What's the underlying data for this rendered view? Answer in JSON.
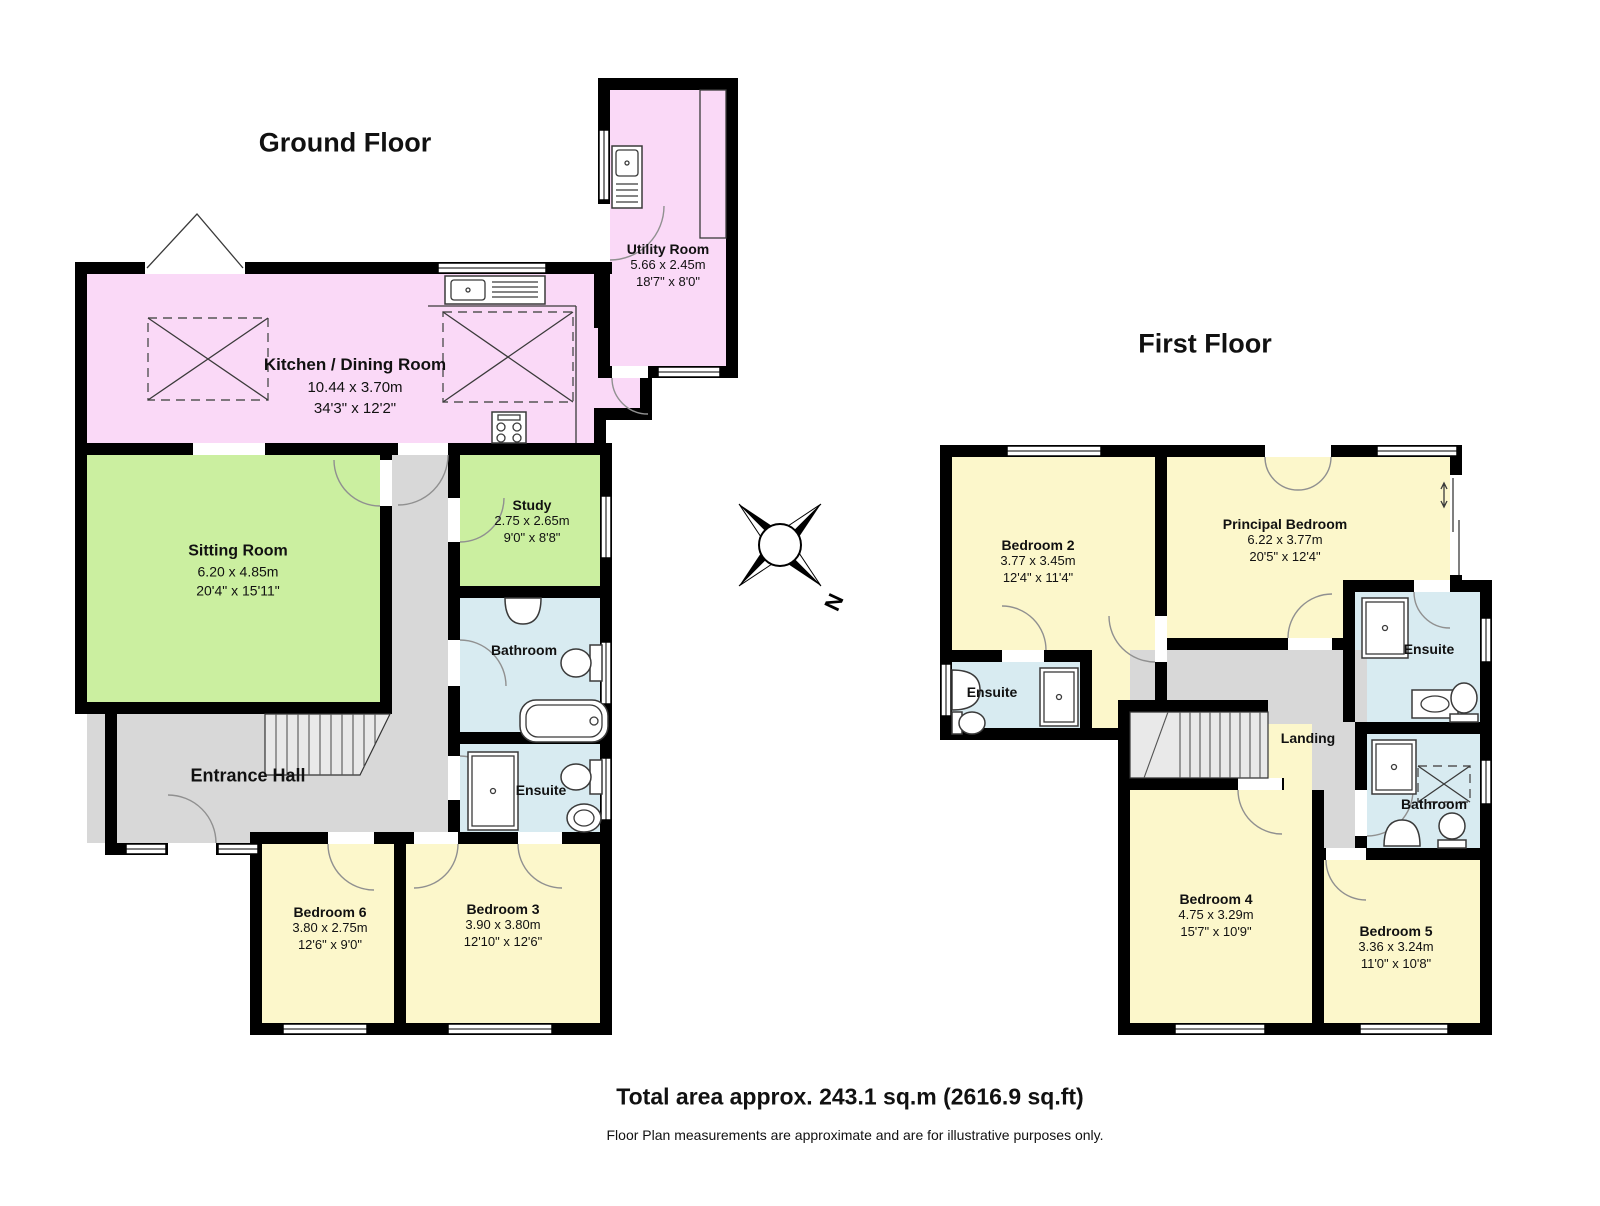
{
  "gf": {
    "title": "Ground Floor",
    "rooms": {
      "utility": {
        "name": "Utility Room",
        "dims_m": "5.66 x 2.45m",
        "dims_ft": "18'7\" x 8'0\""
      },
      "kitchen": {
        "name": "Kitchen / Dining Room",
        "dims_m": "10.44 x 3.70m",
        "dims_ft": "34'3\" x 12'2\""
      },
      "sitting": {
        "name": "Sitting Room",
        "dims_m": "6.20 x 4.85m",
        "dims_ft": "20'4\" x 15'11\""
      },
      "study": {
        "name": "Study",
        "dims_m": "2.75 x 2.65m",
        "dims_ft": "9'0\" x 8'8\""
      },
      "bathroom": {
        "name": "Bathroom"
      },
      "ensuite": {
        "name": "Ensuite"
      },
      "hall": {
        "name": "Entrance Hall"
      },
      "bed6": {
        "name": "Bedroom 6",
        "dims_m": "3.80 x 2.75m",
        "dims_ft": "12'6\" x 9'0\""
      },
      "bed3": {
        "name": "Bedroom 3",
        "dims_m": "3.90 x 3.80m",
        "dims_ft": "12'10\" x 12'6\""
      }
    }
  },
  "ff": {
    "title": "First Floor",
    "rooms": {
      "bed2": {
        "name": "Bedroom 2",
        "dims_m": "3.77 x 3.45m",
        "dims_ft": "12'4\" x 11'4\""
      },
      "principal": {
        "name": "Principal Bedroom",
        "dims_m": "6.22 x 3.77m",
        "dims_ft": "20'5\" x 12'4\""
      },
      "ensuite2": {
        "name": "Ensuite"
      },
      "ensuiteP": {
        "name": "Ensuite"
      },
      "landing": {
        "name": "Landing"
      },
      "bathroom": {
        "name": "Bathroom"
      },
      "bed4": {
        "name": "Bedroom 4",
        "dims_m": "4.75 x 3.29m",
        "dims_ft": "15'7\" x 10'9\""
      },
      "bed5": {
        "name": "Bedroom 5",
        "dims_m": "3.36 x 3.24m",
        "dims_ft": "11'0\" x 10'8\""
      }
    }
  },
  "compass": {
    "label": "N"
  },
  "footer": {
    "total_area": "Total area approx. 243.1 sq.m (2616.9 sq.ft)",
    "disclaimer": "Floor Plan measurements are approximate and are for illustrative purposes only."
  },
  "colors": {
    "kitchen_pink": "#FAD9F7",
    "living_green": "#CBEFA0",
    "bedroom_yellow": "#FCF7CB",
    "bath_blue": "#D8EBF1",
    "hall_gray": "#D8D8D8",
    "wall_black": "#000000"
  }
}
